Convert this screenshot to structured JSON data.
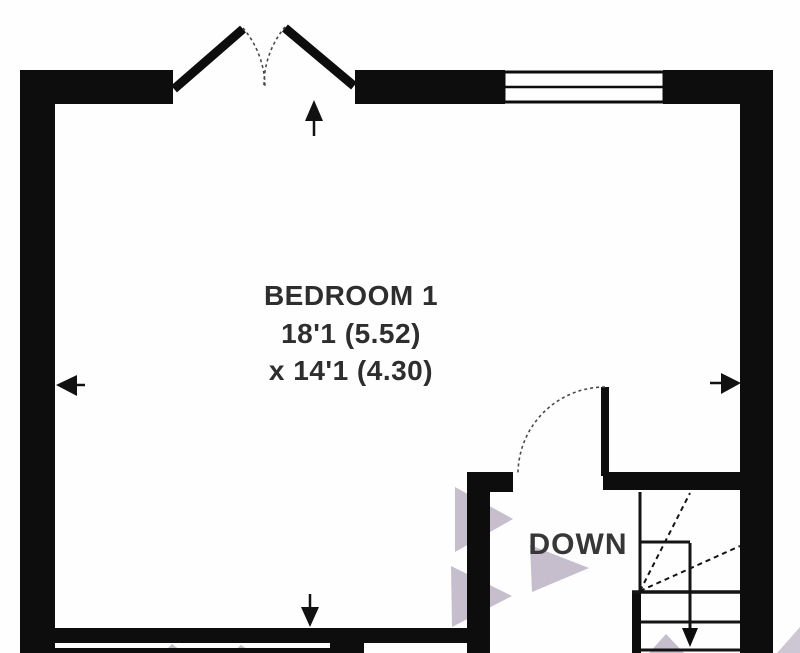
{
  "plan": {
    "room": {
      "name": "BEDROOM 1",
      "dimension_line1": "18'1 (5.52)",
      "dimension_line2": "x 14'1 (4.30)"
    },
    "stairs": {
      "label": "DOWN"
    }
  },
  "colors": {
    "wall": "#0d0d0d",
    "background": "#fefefe",
    "trail": "#c6bdcd",
    "trail_light": "#cdc7d4",
    "text": "#2e2e2e",
    "down_text": "#373737",
    "dash": "#4a4a4a",
    "stair_line": "#141414"
  }
}
